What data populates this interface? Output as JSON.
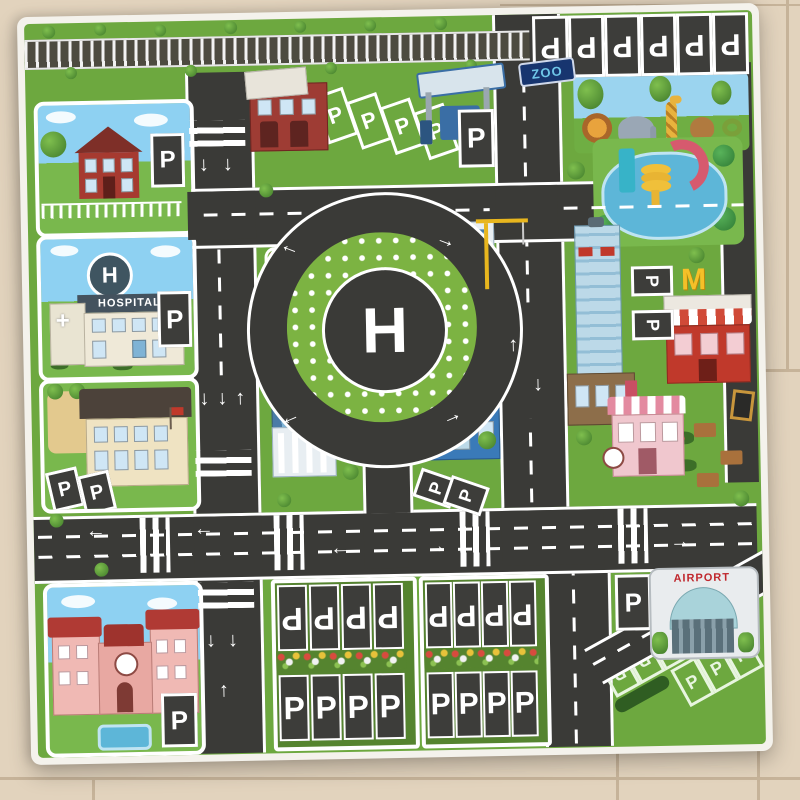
{
  "scene": {
    "subject": "children's city traffic play mat photographed on a beige tile floor",
    "mat_theme": "toy city road map with buildings, helipad roundabout, parking lots, zoo and airport"
  },
  "colors": {
    "floor": "#e2d3bd",
    "grout": "#c6b399",
    "mat_green": "#6da83f",
    "road": "#3a3a37",
    "marking_white": "#ffffff",
    "sky": "#8ed1f2",
    "zoo_sign_bg": "#17356f",
    "zoo_sign_text": "#6fc6e8",
    "accent_red": "#c0392b",
    "airport_text": "#c0272d"
  },
  "labels": {
    "parking": "P",
    "helipad": "H",
    "hospital": "HOSPITAL",
    "hospital_roof": "H",
    "zoo": "ZOO",
    "fire_station": "FIRE STATION",
    "bank": "BANK",
    "airport": "AIRPORT"
  },
  "icons": {
    "arrow_up": "↑",
    "arrow_down": "↓",
    "arrow_left": "←",
    "arrow_right": "→",
    "medical_cross": "+",
    "golden_arches": "M"
  }
}
